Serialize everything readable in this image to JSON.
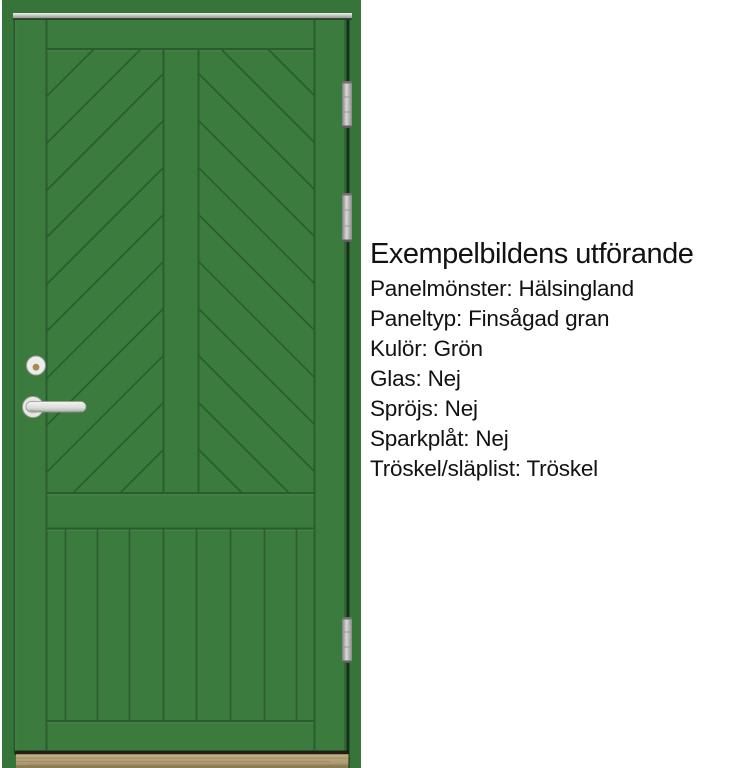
{
  "specs": {
    "title": "Exempelbildens utförande",
    "lines": [
      "Panelmönster: Hälsingland",
      "Paneltyp: Finsågad gran",
      "Kulör: Grön",
      "Glas: Nej",
      "Spröjs: Nej",
      "Sparkplåt: Nej",
      "Tröskel/släplist: Tröskel"
    ]
  },
  "door": {
    "color_name": "Grön",
    "panel_pattern": "Hälsingland",
    "colors": {
      "background": "#ffffff",
      "frame": "#377439",
      "leaf": "#3b7b3e",
      "groove": "#2a5c2e",
      "groove_light": "#4b8a4e",
      "gap_dark": "#16301a",
      "metal": "#c6c6c4",
      "hinge": "#b2b2b0",
      "handle": "#e9e9e6",
      "brass": "#a8894e",
      "wood": "#b4a276",
      "wood_dark": "#8b7b56",
      "shadow": "#241f15",
      "text": "#121212"
    }
  }
}
